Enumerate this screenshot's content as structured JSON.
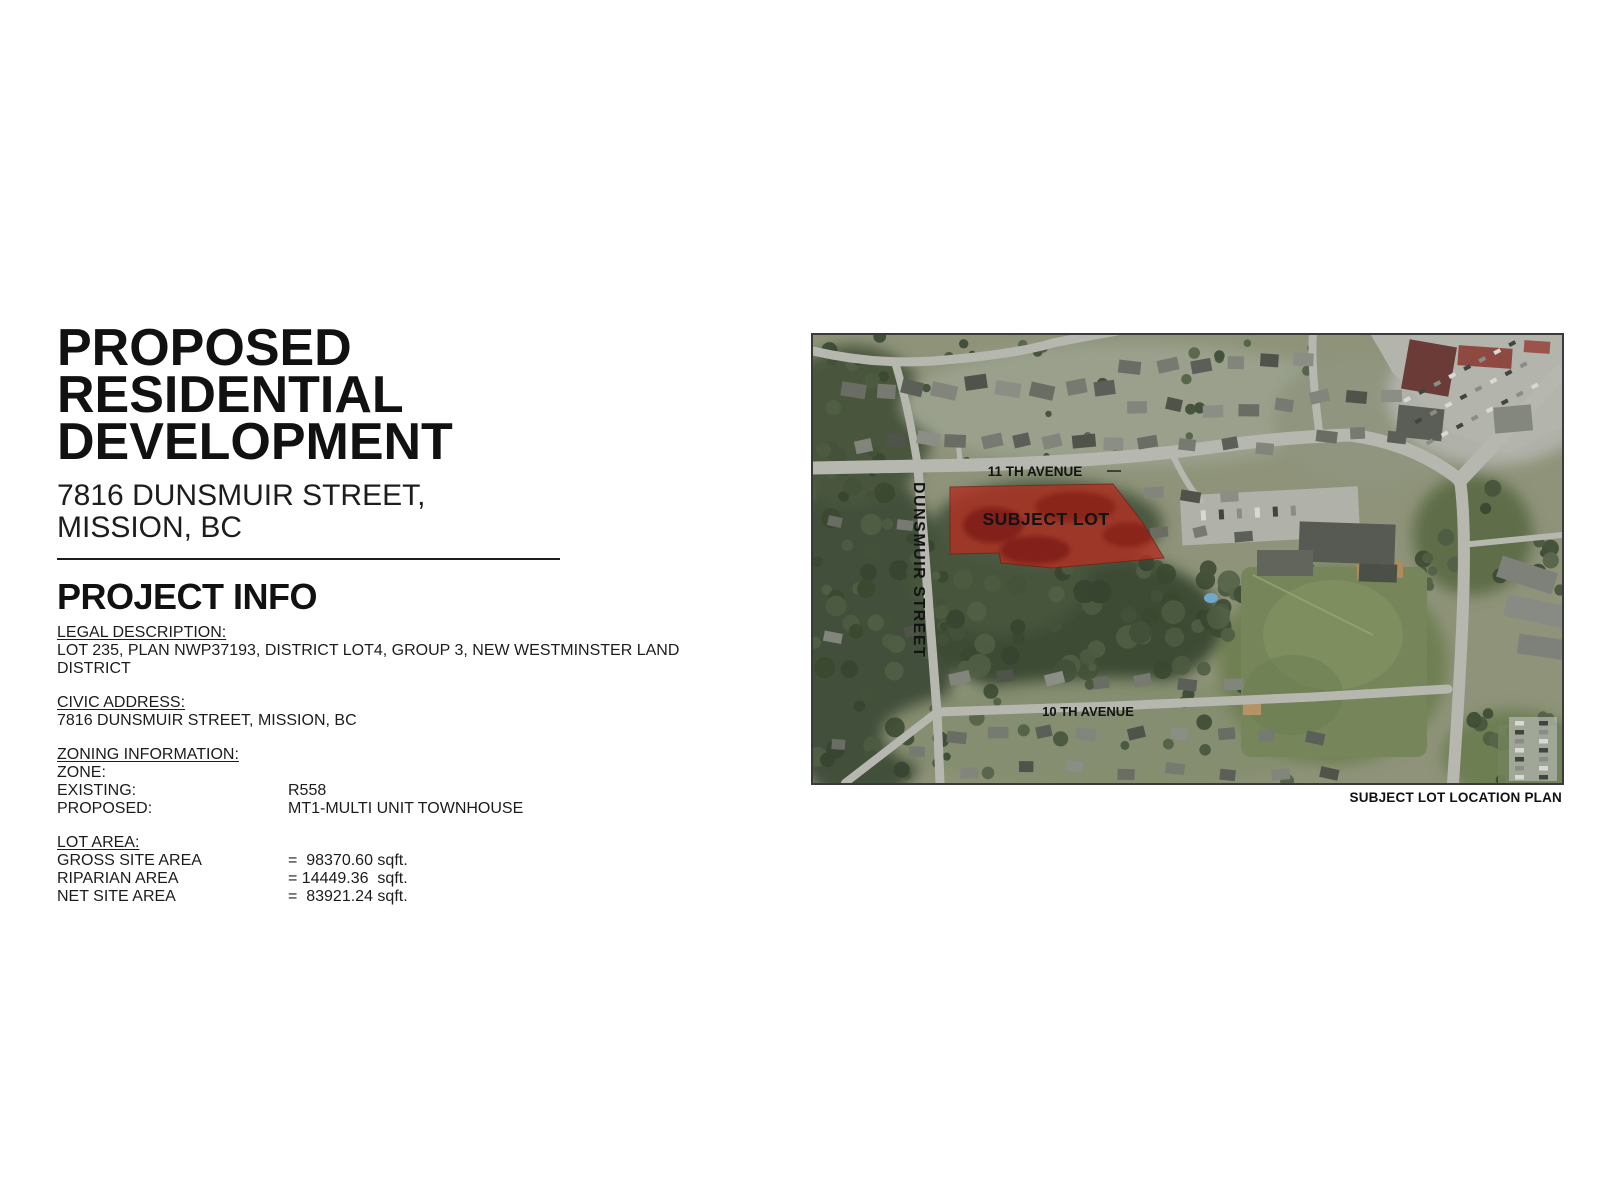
{
  "page": {
    "title_lines": [
      "PROPOSED",
      "RESIDENTIAL",
      "DEVELOPMENT"
    ],
    "subtitle": "7816 DUNSMUIR STREET, MISSION, BC",
    "section_heading": "PROJECT INFO"
  },
  "project_info": {
    "legal": {
      "label": "LEGAL DESCRIPTION:",
      "value": "LOT 235, PLAN NWP37193, DISTRICT LOT4, GROUP 3, NEW WESTMINSTER LAND DISTRICT"
    },
    "civic": {
      "label": "CIVIC ADDRESS:",
      "value": "7816 DUNSMUIR STREET, MISSION, BC"
    },
    "zoning": {
      "label": "ZONING INFORMATION:",
      "rows": [
        {
          "name": "ZONE:",
          "value": ""
        },
        {
          "name": "EXISTING:",
          "value": "R558"
        },
        {
          "name": "PROPOSED:",
          "value": "MT1-MULTI UNIT TOWNHOUSE"
        }
      ]
    },
    "lot_area": {
      "label": "LOT AREA:",
      "rows": [
        {
          "name": "GROSS SITE AREA",
          "value": "=  98370.60 sqft."
        },
        {
          "name": "RIPARIAN AREA",
          "value": "= 14449.36  sqft."
        },
        {
          "name": "NET SITE AREA",
          "value": "=  83921.24 sqft."
        }
      ]
    }
  },
  "map": {
    "labels": {
      "avenue11": "11 TH AVENUE",
      "dunsmuir": "DUNSMUIR STREET",
      "avenue10": "10 TH AVENUE",
      "subject_lot": "SUBJECT LOT"
    },
    "caption": "SUBJECT LOT LOCATION PLAN",
    "colors": {
      "subject_lot_fill": "#b23124",
      "road": "#b6b8b0",
      "field": "#76865a"
    }
  }
}
